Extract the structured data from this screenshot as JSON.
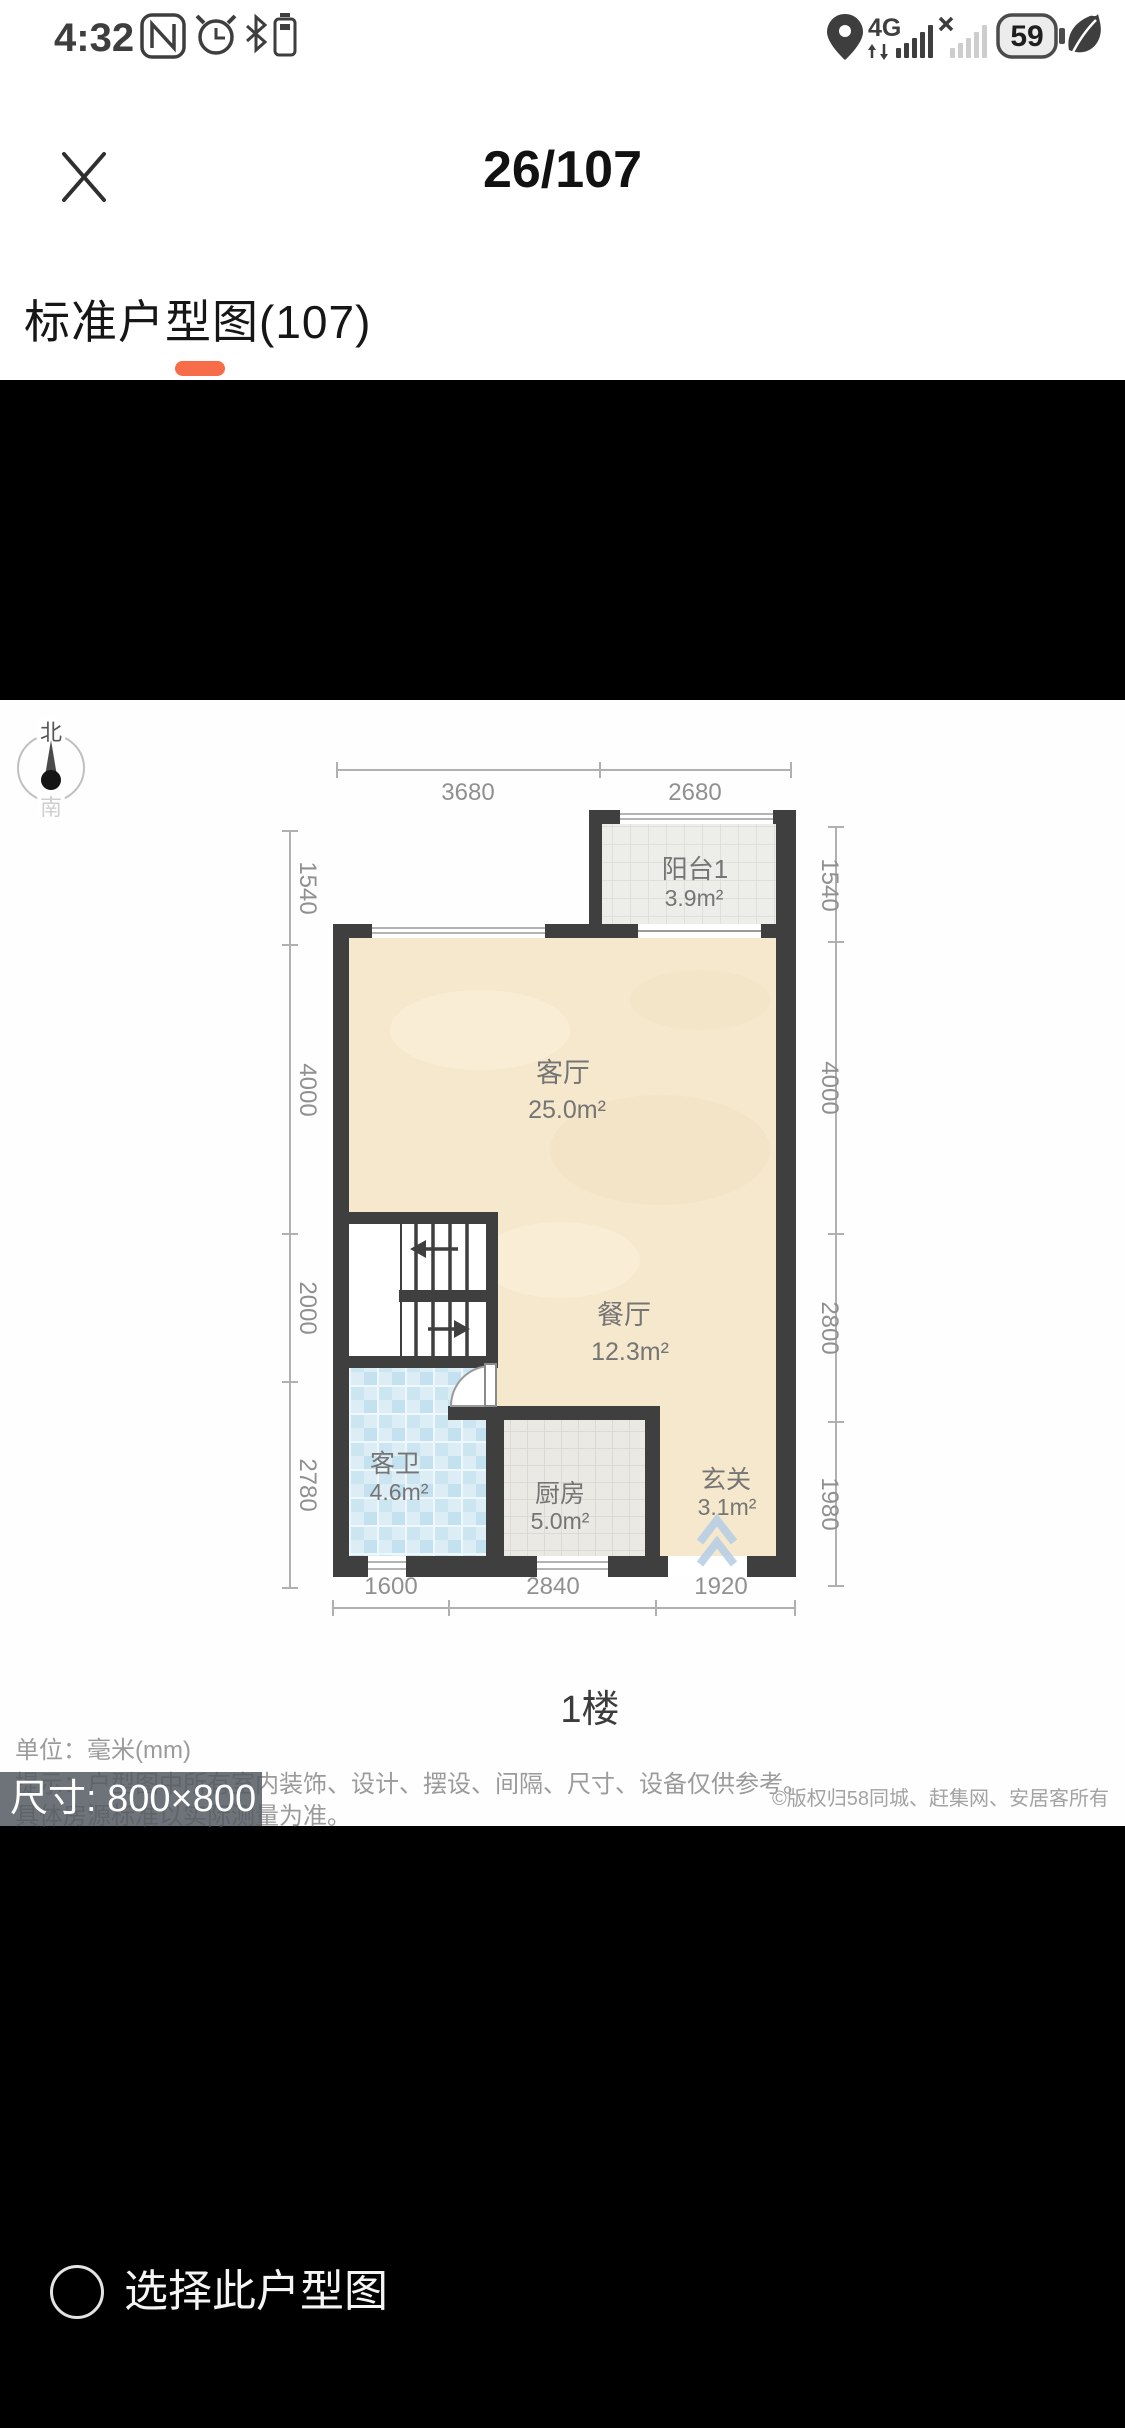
{
  "status_bar": {
    "time": "4:32",
    "network_type": "4G",
    "battery_level": "59"
  },
  "viewer": {
    "counter": "26/107",
    "tab_label": "标准户型图(107)",
    "accent_color": "#f76c49"
  },
  "floorplan": {
    "compass": {
      "north": "北",
      "south": "南"
    },
    "dims": {
      "top": [
        "3680",
        "2680"
      ],
      "left": [
        "1540",
        "4000",
        "2000",
        "2780"
      ],
      "right": [
        "1540",
        "4000",
        "2800",
        "1980"
      ],
      "bottom": [
        "1600",
        "2840",
        "1920"
      ]
    },
    "rooms": [
      {
        "name": "阳台1",
        "area": "3.9m²"
      },
      {
        "name": "客厅",
        "area": "25.0m²"
      },
      {
        "name": "餐厅",
        "area": "12.3m²"
      },
      {
        "name": "客卫",
        "area": "4.6m²"
      },
      {
        "name": "厨房",
        "area": "5.0m²"
      },
      {
        "name": "玄关",
        "area": "3.1m²"
      }
    ],
    "floor_label": "1楼"
  },
  "meta": {
    "unit_line": "单位：毫米(mm)",
    "tip_line": "提示：户型图中所有室内装饰、设计、摆设、间隔、尺寸、设备仅供参考。",
    "tip_line2": "具体房源标准以实际测量为准。",
    "size_badge": "尺寸: 800×800",
    "copyright": "©版权归58同城、赶集网、安居客所有"
  },
  "footer": {
    "select_label": "选择此户型图"
  }
}
